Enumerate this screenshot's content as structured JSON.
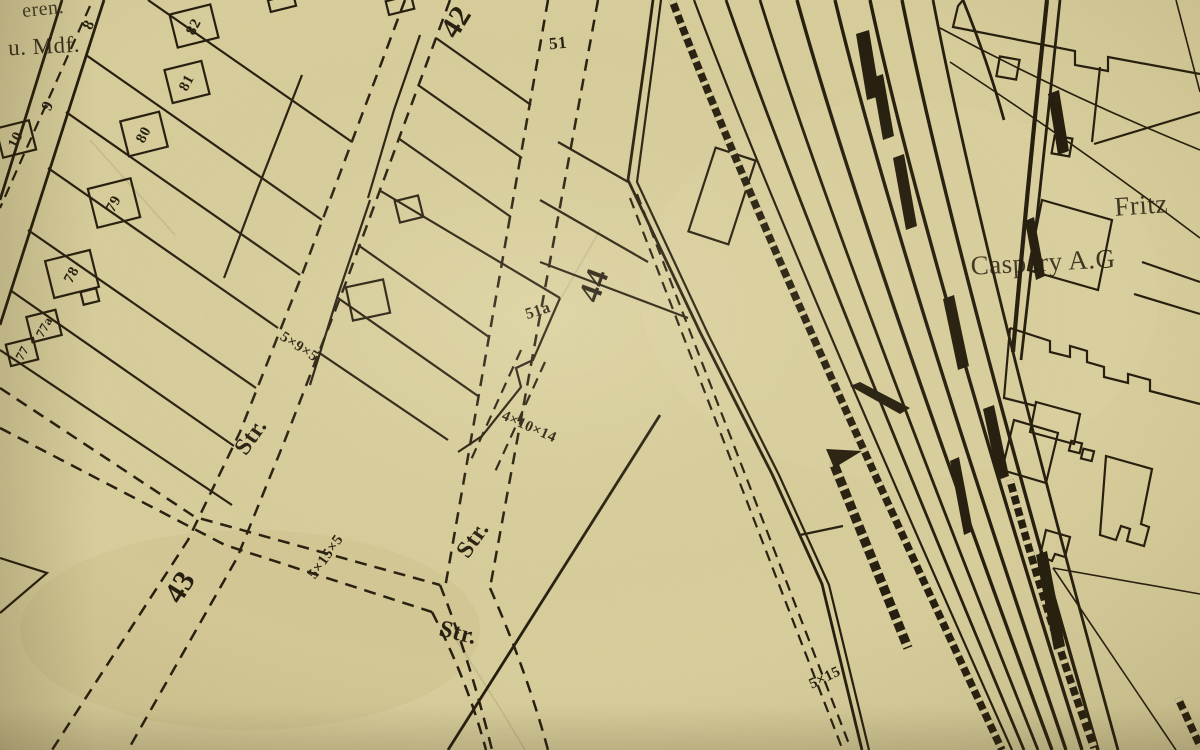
{
  "colors": {
    "paper": "#dbd1a0",
    "ink": "#221b0d"
  },
  "corner_note": {
    "line1": "eren.",
    "line2": "u. Mdf."
  },
  "company": {
    "line1": "Fritz",
    "line2": "Caspary A.G"
  },
  "street_abbrev": {
    "s1": "Str.",
    "s2": "Str.",
    "s3": "Str."
  },
  "block_numbers": {
    "b42": "42",
    "b43": "43",
    "b44": "44",
    "b51": "51",
    "b51a": "51a"
  },
  "house_numbers": {
    "h8": "8",
    "h9": "9",
    "h10": "10",
    "h77": "77",
    "h77a": "77a",
    "h78": "78",
    "h79": "79",
    "h80": "80",
    "h81": "81",
    "h82": "82"
  },
  "dimensions": {
    "d1": "5×9×5",
    "d2": "4×10×14",
    "d3": "5×15×5",
    "d4": "5×15"
  }
}
